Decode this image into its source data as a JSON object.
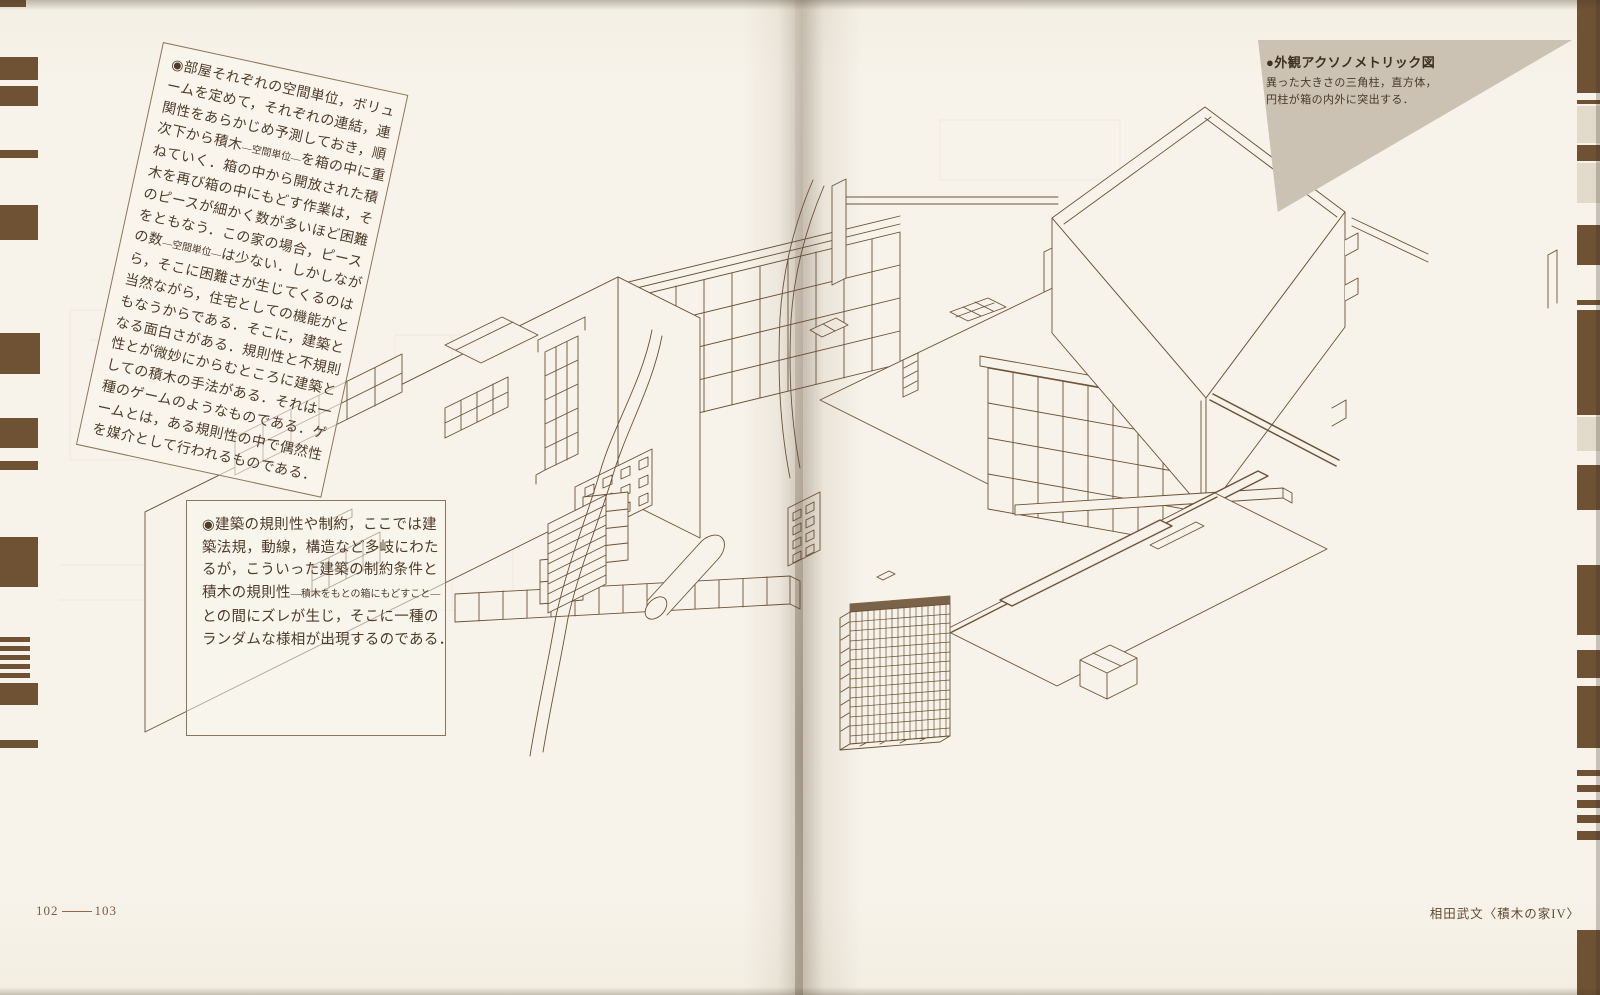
{
  "page": {
    "folio_left": "102",
    "folio_right": "103",
    "credit": "相田武文〈積木の家IV〉"
  },
  "figure_caption": {
    "title": "●外観アクソノメトリック図",
    "lines": [
      "異った大きさの三角柱，直方体，",
      "円柱が箱の内外に突出する．"
    ]
  },
  "note_rotated": {
    "lines": [
      "◉部屋それぞれの空間単位，ボリュ",
      "ームを定めて，それぞれの連結，連",
      "関性をあらかじめ予測しておき，順",
      {
        "segs": [
          {
            "t": "次下から積木"
          },
          {
            "t": "—空間単位—",
            "small": true
          },
          {
            "t": "を箱の中に重"
          }
        ]
      },
      "ねていく．箱の中から開放された積",
      "木を再び箱の中にもどす作業は，そ",
      "のピースが細かく数が多いほど困難",
      "をともなう．この家の場合，ピース",
      {
        "segs": [
          {
            "t": "の数"
          },
          {
            "t": "—空間単位—",
            "small": true
          },
          {
            "t": "は少ない．しかしなが"
          }
        ]
      },
      "ら，そこに困難さが生じてくるのは",
      "当然ながら，住宅としての機能がと",
      "もなうからである．そこに，建築と",
      "なる面白さがある．規則性と不規則",
      "性とが微妙にからむところに建築と",
      "しての積木の手法がある．それは一",
      "種のゲームのようなものである．ゲ",
      "ームとは，ある規則性の中で偶然性",
      "を媒介として行われるものである．"
    ]
  },
  "note_box": {
    "lines": [
      "◉建築の規則性や制約，ここでは建",
      "築法規，動線，構造など多岐にわた",
      "るが，こういった建築の制約条件と",
      {
        "segs": [
          {
            "t": "積木の規則性"
          },
          {
            "t": "—積木をもとの箱にもどすこと—",
            "small": true
          }
        ]
      },
      "との間にズレが生じ，そこに一種の",
      "ランダムな様相が出現するのである．"
    ]
  },
  "colors": {
    "ink": "#6d5134",
    "registration_stripe": "#6f5233",
    "caption_background": "#cbc2b3",
    "page": "#f7f3ea",
    "text": "#4e3b28"
  }
}
